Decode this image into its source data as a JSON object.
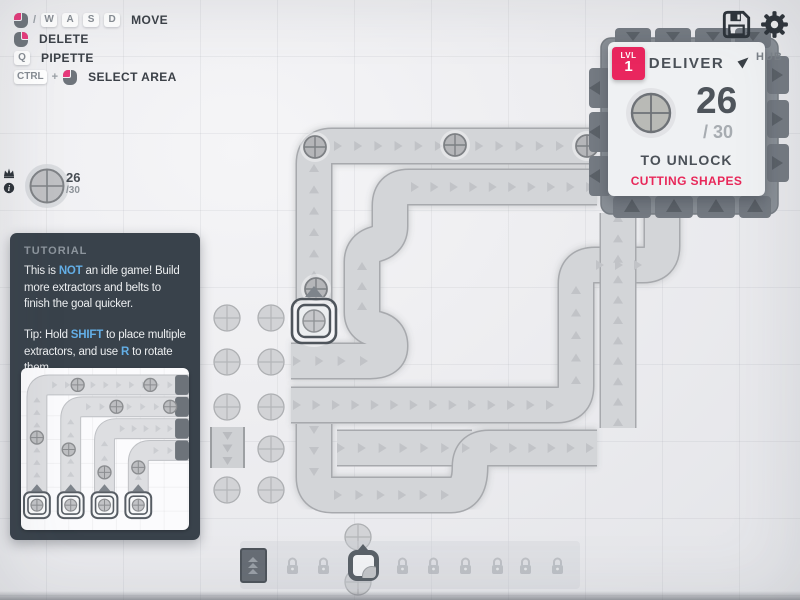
{
  "hints": {
    "rows": [
      {
        "label": "MOVE",
        "sep": "/",
        "keys": [
          "W",
          "A",
          "S",
          "D"
        ]
      },
      {
        "label": "DELETE"
      },
      {
        "label": "PIPETTE",
        "keys": [
          "Q"
        ]
      },
      {
        "label": "SELECT AREA",
        "keys": [
          "CTRL"
        ],
        "sep": "+"
      }
    ]
  },
  "stats": {
    "value": "26",
    "of": "/30"
  },
  "goal": {
    "lvl_label": "LVL",
    "lvl_value": "1",
    "title": "DELIVER",
    "value": "26",
    "of": "/ 30",
    "to_unlock": "TO UNLOCK",
    "reward": "CUTTING SHAPES",
    "hub_label": "HUB"
  },
  "tutorial": {
    "title": "TUTORIAL",
    "p1": [
      "This is ",
      "NOT",
      " an idle game! Build more extractors and belts to finish the goal quicker."
    ],
    "p2": [
      "Tip: Hold ",
      "SHIFT",
      " to place multiple extractors, and use ",
      "R",
      " to rotate them."
    ]
  },
  "toolbar": {
    "slots": [
      {
        "icon": "belt-icon",
        "locked": false
      },
      {
        "icon": "lock-icon",
        "locked": true
      },
      {
        "icon": "lock-icon",
        "locked": true
      },
      {
        "icon": "miner-icon",
        "locked": false
      },
      {
        "icon": "lock-icon",
        "locked": true
      },
      {
        "icon": "lock-icon",
        "locked": true
      },
      {
        "icon": "lock-icon",
        "locked": true
      },
      {
        "icon": "lock-icon",
        "locked": true
      },
      {
        "icon": "lock-icon",
        "locked": true
      },
      {
        "icon": "lock-icon",
        "locked": true
      }
    ]
  },
  "colors": {
    "accent_pink": "#e9265e",
    "hint_blue": "#63aee6"
  }
}
